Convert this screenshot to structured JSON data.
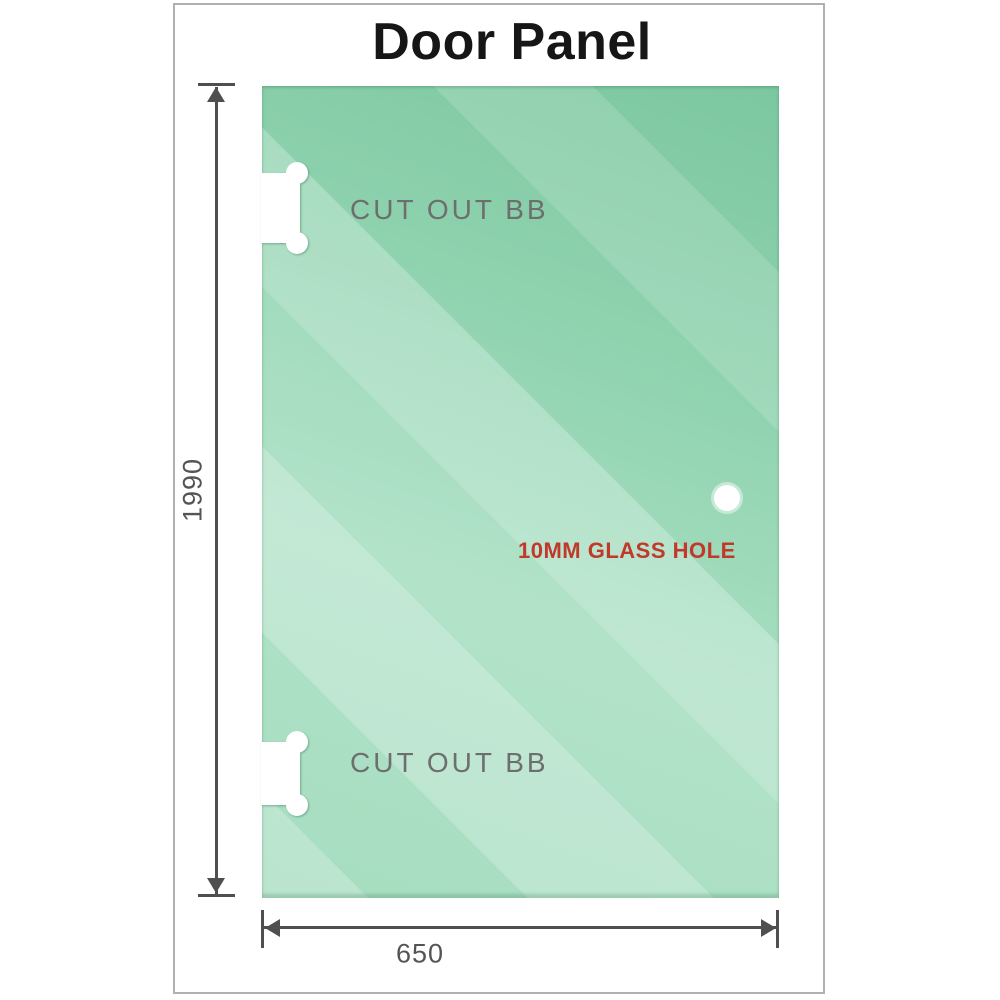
{
  "title": "Door Panel",
  "panel": {
    "type": "glass-door-panel",
    "cutouts": [
      {
        "label": "CUT OUT BB",
        "position": "top-left"
      },
      {
        "label": "CUT OUT BB",
        "position": "bottom-left"
      }
    ],
    "glass_hole": {
      "label": "10MM GLASS HOLE"
    }
  },
  "dimensions": {
    "height": {
      "value": "1990"
    },
    "width": {
      "value": "650"
    }
  },
  "colors": {
    "glass_green_dark": "#7cc7a0",
    "glass_green_light": "#c8ecd8",
    "dimension_line": "#4f4f4f",
    "cutout_label_gray": "#6e6e6e",
    "hole_label_red": "#c0392b",
    "frame_border": "#b0b0b0",
    "title_text": "#161616"
  },
  "icons": {
    "arrow_up": "dimension-arrowhead-up",
    "arrow_down": "dimension-arrowhead-down",
    "arrow_left": "dimension-arrowhead-left",
    "arrow_right": "dimension-arrowhead-right"
  }
}
